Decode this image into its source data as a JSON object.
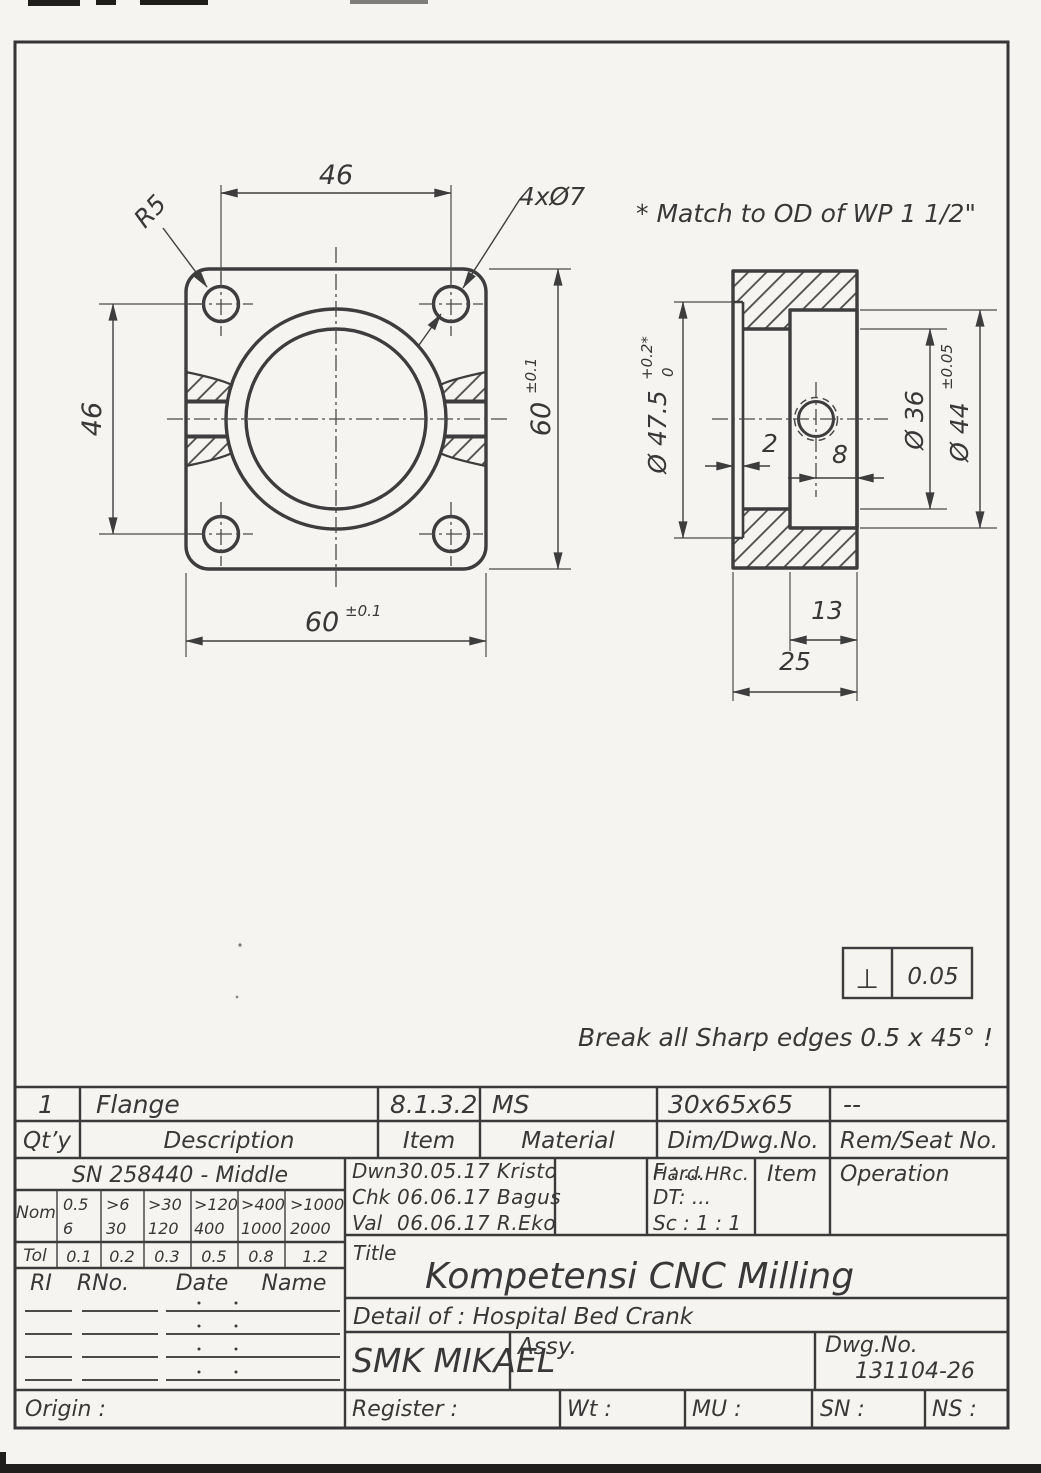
{
  "colors": {
    "paper": "#f5f4f0",
    "ink": "#3d3d3d"
  },
  "annotations": {
    "match_note": "* Match to OD of WP 1 1/2\"",
    "break_note": "Break all Sharp edges 0.5 x 45° !",
    "perp_symbol": "⊥",
    "perp_value": "0.05"
  },
  "front": {
    "dim_top": "46",
    "dim_left": "46",
    "dim_right": "60",
    "dim_right_tol": "±0.1",
    "dim_bottom": "60",
    "dim_bottom_tol": "±0.1",
    "holes": "4xØ7",
    "radius": "R5"
  },
  "side": {
    "bore": "Ø 47.5",
    "bore_tol_plus": "+0.2*",
    "bore_tol_minus": "0",
    "lip": "2",
    "hole_offset": "8",
    "inner": "Ø 36",
    "boss": "Ø 44",
    "boss_tol": "±0.05",
    "boss_len": "13",
    "total": "25"
  },
  "title_block": {
    "row1": {
      "qty": "1",
      "description": "Flange",
      "item": "8.1.3.2",
      "material": "MS",
      "dim_dwg": "30x65x65",
      "rem": "--"
    },
    "row2": {
      "qty": "Qt’y",
      "description": "Description",
      "item": "Item",
      "material": "Material",
      "dim_dwg": "Dim/Dwg.No.",
      "rem": "Rem/Seat No."
    },
    "standard": "SN 258440 - Middle",
    "tol_table": {
      "nom_label": "Nom",
      "tol_label": "Tol",
      "ranges": [
        [
          "0.5",
          "6"
        ],
        [
          ">6",
          "30"
        ],
        [
          ">30",
          "120"
        ],
        [
          ">120",
          "400"
        ],
        [
          ">400",
          "1000"
        ],
        [
          ">1000",
          "2000"
        ]
      ],
      "tols": [
        "0.1",
        "0.2",
        "0.3",
        "0.5",
        "0.8",
        "1.2"
      ]
    },
    "signoff": {
      "dwn_label": "Dwn",
      "dwn": "30.05.17 Kristo",
      "chk_label": "Chk",
      "chk": "06.06.17 Bagus",
      "val_label": "Val",
      "val": "06.06.17 R.Eko",
      "f": "F : ...",
      "dt": "DT: ...",
      "sc": "Sc : 1 : 1"
    },
    "op_headers": {
      "hard": "Hard.HRc.",
      "item": "Item",
      "operation": "Operation"
    },
    "revision": {
      "ri": "RI",
      "rno": "RNo.",
      "date": "Date",
      "name": "Name"
    },
    "title_label": "Title",
    "title": "Kompetensi CNC Milling",
    "detail": "Detail of : Hospital Bed Crank",
    "company": "SMK MIKAEL",
    "assy": "Assy.",
    "dwg_label": "Dwg.No.",
    "dwg_no": "131104-26",
    "origin": "Origin :",
    "register": "Register :",
    "wt": "Wt :",
    "mu": "MU :",
    "sn": "SN :",
    "ns": "NS :"
  }
}
